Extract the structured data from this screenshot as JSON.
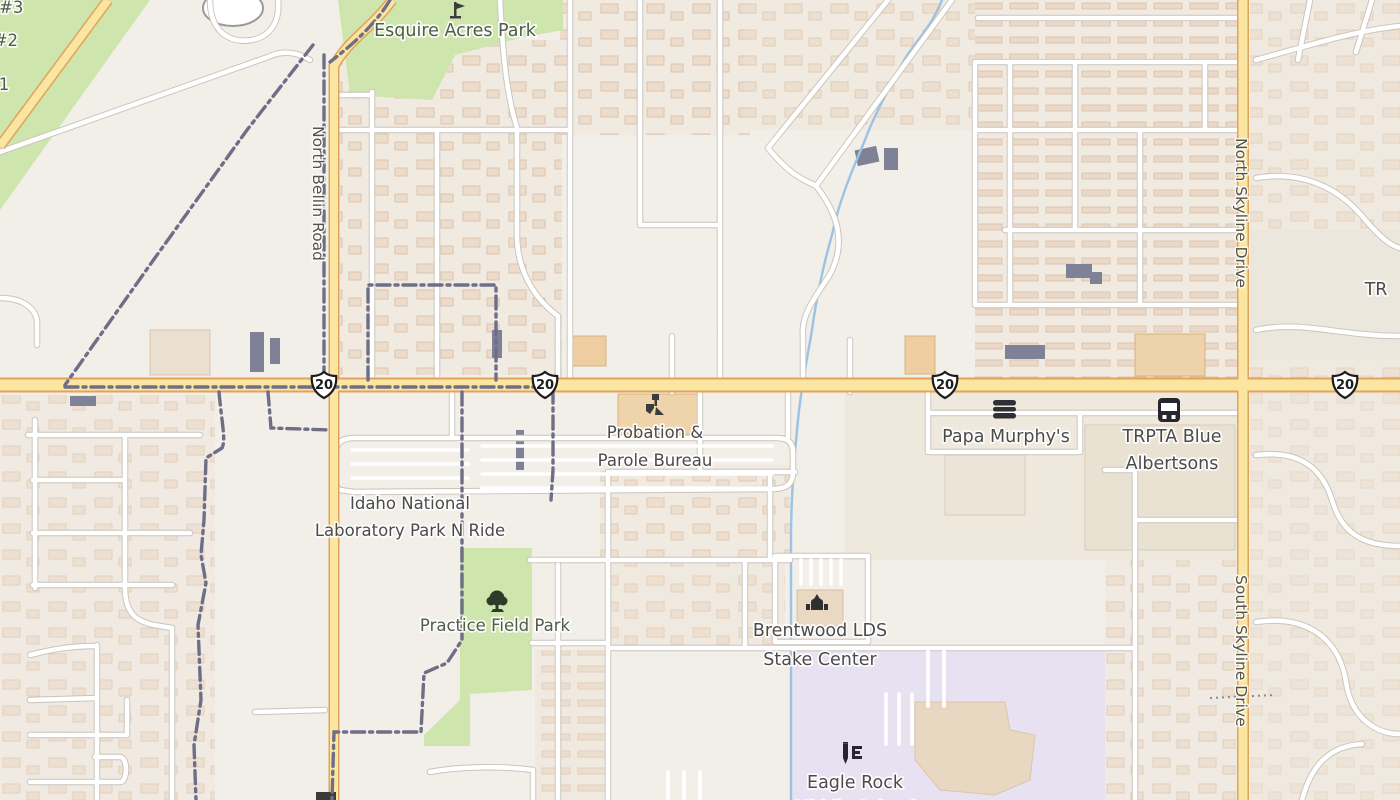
{
  "map": {
    "labels": {
      "field3_partial": "eld #3",
      "field2_partial": "d #2",
      "field1_partial": "1",
      "esquire_park": "Esquire Acres Park",
      "north_bellin_road": "North Bellin Road",
      "north_skyline_drive": "North Skyline Drive",
      "south_skyline_drive": "South Skyline Drive",
      "tr_partial": "TR",
      "route_shield": "20",
      "probation_line1": "Probation &",
      "probation_line2": "Parole Bureau",
      "papa_murphys": "Papa Murphy's",
      "trpta_blue": "TRPTA Blue",
      "albertsons": "Albertsons",
      "inl_line1": "Idaho National",
      "inl_line2": "Laboratory Park N Ride",
      "practice_field_park": "Practice Field Park",
      "brentwood_line1": "Brentwood LDS",
      "brentwood_line2": "Stake Center",
      "eagle_rock_line1": "Eagle Rock",
      "eagle_rock_line2_partial": "Middle School"
    },
    "icons": {
      "playground": "playground-icon",
      "government": "government-office-icon",
      "fast_food": "fast-food-icon",
      "bus": "bus-stop-icon",
      "tree": "park-tree-icon",
      "church": "church-icon",
      "school": "school-icon"
    },
    "colors": {
      "background": "#f2efe9",
      "residential": "#f1eae1",
      "park_green": "#cfe5ae",
      "school_lavender": "#e8e1f1",
      "road_primary_fill": "#fae6a0",
      "road_primary_casing": "#e2a25c",
      "road_minor_fill": "#ffffff",
      "road_minor_casing": "#c9c4bb",
      "water": "#9cc2e4",
      "boundary": "#6e6f87",
      "building": "#ecdccb",
      "building_dark": "#7f8296",
      "poi_label": "#4b4b4b",
      "park_label": "#4e5c48",
      "street_label": "#55544a"
    }
  }
}
